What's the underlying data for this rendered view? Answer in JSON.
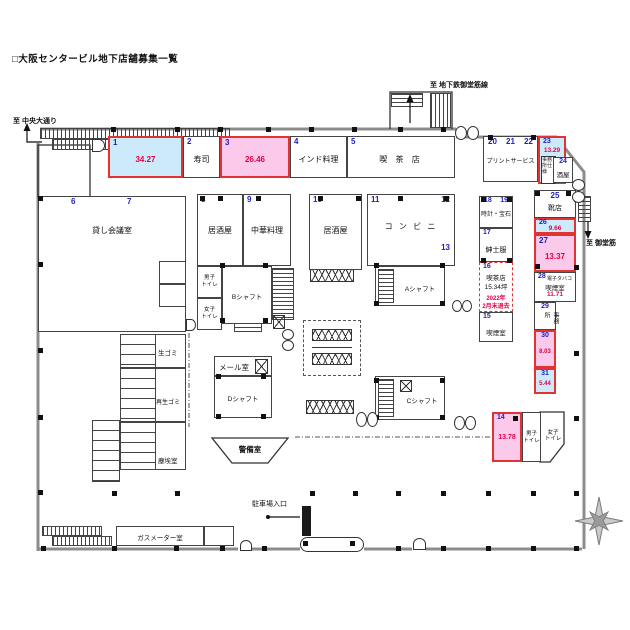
{
  "title": "□大阪センタービル地下店舗募集一覧",
  "directions": {
    "chuo_odori": "至 中央大通り",
    "subway_midosuji": "至 地下鉄御堂筋線",
    "midosuji": "至 御堂筋",
    "parking_entrance": "駐車場入口"
  },
  "colors": {
    "vacant_blue": "#cdeafb",
    "vacant_pink": "#fbc9e9",
    "vacant_border_red": "#e23333",
    "unit_number_blue": "#2020c0",
    "area_value_red": "#e80045",
    "wall_gray": "#8c8c8c"
  },
  "units": {
    "u1": {
      "no": "1",
      "area": "34.27"
    },
    "u2": {
      "no": "2",
      "name": "寿司"
    },
    "u3": {
      "no": "3",
      "area": "26.46"
    },
    "u4": {
      "no": "4",
      "name": "インド料理"
    },
    "u5": {
      "no": "5",
      "name": "喫 茶 店"
    },
    "u67": {
      "no1": "6",
      "no2": "7",
      "name": "貸し会議室"
    },
    "u8": {
      "no": "8",
      "name": "居酒屋"
    },
    "u9": {
      "no": "9",
      "name": "中華料理"
    },
    "u10": {
      "no": "10",
      "name": "居酒屋"
    },
    "u11_13": {
      "no1": "11",
      "no2": "12",
      "no3": "13",
      "name": "コ ン ビ ニ"
    },
    "u14": {
      "no": "14",
      "area": "13.78"
    },
    "u15": {
      "no": "15",
      "name": "喫煙室"
    },
    "u16": {
      "no": "16",
      "name": "喫茶店",
      "size": "15.34坪",
      "note1": "2022年",
      "note2": "2月末退去"
    },
    "u17": {
      "no": "17",
      "name": "紳士服"
    },
    "u18_19": {
      "no1": "18",
      "no2": "19",
      "name": "時計・宝石"
    },
    "u20_22": {
      "no1": "20",
      "no2": "21",
      "no3": "22",
      "name": "プリントサービス"
    },
    "u23": {
      "no": "23",
      "area": "13.29",
      "note": "事務所仕様"
    },
    "u24": {
      "no": "24",
      "name": "酒屋"
    },
    "u25": {
      "no": "25",
      "name": "靴店"
    },
    "u26": {
      "no": "26",
      "area": "9.66"
    },
    "u27": {
      "no": "27",
      "area": "13.37"
    },
    "u28": {
      "no": "28",
      "name1": "電子タバコ",
      "name2": "喫煙室",
      "area": "11.71"
    },
    "u29": {
      "no": "29",
      "name": "事務所"
    },
    "u30": {
      "no": "30",
      "area": "8.03"
    },
    "u31": {
      "no": "31",
      "area": "5.44"
    }
  },
  "facilities": {
    "shaft_a": "Aシャフト",
    "shaft_b": "Bシャフト",
    "shaft_c": "Cシャフト",
    "shaft_d": "Dシャフト",
    "mail_room": "メール室",
    "security_room": "警備室",
    "raw_garbage": "生ゴミ",
    "recycle_garbage": "再生ゴミ",
    "dust_room": "塵埃室",
    "gas_meter_room": "ガスメーター室",
    "mens_toilet": {
      "l1": "男子",
      "l2": "トイレ"
    },
    "womens_toilet": {
      "l1": "女子",
      "l2": "トイレ"
    }
  }
}
